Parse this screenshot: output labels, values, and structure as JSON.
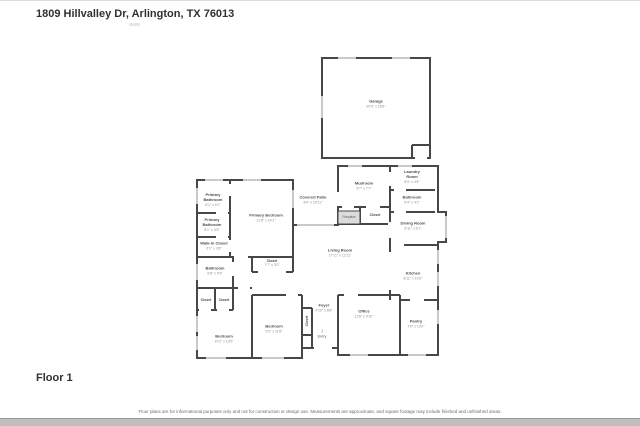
{
  "page": {
    "title": "1809 Hillvalley Dr, Arlington, TX 76013",
    "floor_label": "Floor 1",
    "disclaimer": "Floor plans are for informational purposes only and not for construction or design use. Measurements are approximate, and square footage may include finished and unfinished areas."
  },
  "colors": {
    "wall": "#474747",
    "window": "#c9c9c9",
    "fireplace_fill": "#dcdcdc",
    "room_name_text": "#4d4d4d",
    "room_dims_text": "#8e8e8e"
  },
  "rooms": [
    {
      "id": "garage",
      "name": "Garage",
      "dims": "20'0\" x 18'6\""
    },
    {
      "id": "mudroom",
      "name": "Mudroom",
      "dims": "9'7\" x 7'7\""
    },
    {
      "id": "laundry-room",
      "name": "Laundry Room",
      "dims": "8'4\" x 4'5\""
    },
    {
      "id": "bathroom-upper",
      "name": "Bathroom",
      "dims": "8'4\" x 4'1\""
    },
    {
      "id": "covered-patio",
      "name": "Covered Patio",
      "dims": "8'4\" x 10'11\""
    },
    {
      "id": "closet-hall",
      "name": "Closet",
      "dims": ""
    },
    {
      "id": "dining-room",
      "name": "Dining Room",
      "dims": "8'11\" x 6'1\""
    },
    {
      "id": "primary-bathroom-1",
      "name": "Primary Bathroom",
      "dims": "6'1\" x 6'1\""
    },
    {
      "id": "primary-bathroom-2",
      "name": "Primary Bathroom",
      "dims": "6'1\" x 4'5\""
    },
    {
      "id": "primary-bedroom",
      "name": "Primary Bedroom",
      "dims": "11'8\" x 14'1\""
    },
    {
      "id": "walk-in-closet",
      "name": "Walk-in Closet",
      "dims": "6'1\" x 3'8\""
    },
    {
      "id": "bathroom-left",
      "name": "Bathroom",
      "dims": "6'8\" x 5'9\""
    },
    {
      "id": "closet-a",
      "name": "Closet",
      "dims": ""
    },
    {
      "id": "closet-b",
      "name": "Closet",
      "dims": ""
    },
    {
      "id": "bedroom-left",
      "name": "Bedroom",
      "dims": "10'2\" x 13'0\""
    },
    {
      "id": "closet-mid",
      "name": "Closet",
      "dims": "7'7\" x 3'0\""
    },
    {
      "id": "bedroom-center",
      "name": "Bedroom",
      "dims": "9'3\" x 11'8\""
    },
    {
      "id": "closet-vertical",
      "name": "Closet",
      "dims": ""
    },
    {
      "id": "foyer",
      "name": "Foyer",
      "dims": "4'10\" x 6'6\""
    },
    {
      "id": "living-room",
      "name": "Living Room",
      "dims": "17'11\" x 12'11\""
    },
    {
      "id": "office",
      "name": "Office",
      "dims": "11'6\" x 9'10\""
    },
    {
      "id": "kitchen",
      "name": "Kitchen",
      "dims": "8'11\" x 10'2\""
    },
    {
      "id": "pantry",
      "name": "Pantry",
      "dims": "7'0\" x 10'2\""
    }
  ],
  "fixtures": {
    "fireplace_label": "Fireplace",
    "entry_label": "Entry",
    "entry_icon": "down-arrow"
  }
}
